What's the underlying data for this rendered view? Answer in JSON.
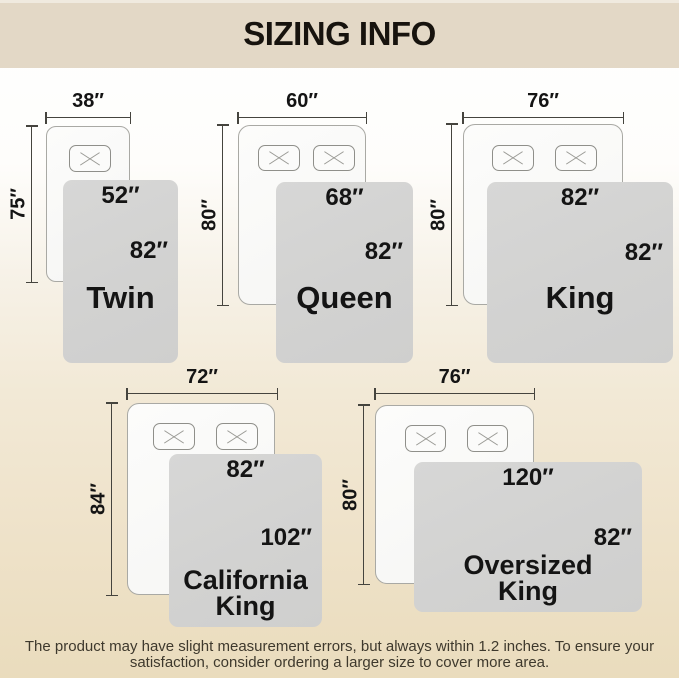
{
  "header": {
    "title": "SIZING INFO"
  },
  "sizes": [
    {
      "name": "Twin",
      "bed_width": "38″",
      "bed_length": "75″",
      "blanket_width": "52″",
      "blanket_length": "82″"
    },
    {
      "name": "Queen",
      "bed_width": "60″",
      "bed_length": "80″",
      "blanket_width": "68″",
      "blanket_length": "82″"
    },
    {
      "name": "King",
      "bed_width": "76″",
      "bed_length": "80″",
      "blanket_width": "82″",
      "blanket_length": "82″"
    },
    {
      "name": "California King",
      "bed_width": "72″",
      "bed_length": "84″",
      "blanket_width": "82″",
      "blanket_length": "102″"
    },
    {
      "name": "Oversized King",
      "bed_width": "76″",
      "bed_length": "80″",
      "blanket_width": "120″",
      "blanket_length": "82″"
    }
  ],
  "footer": {
    "line1": "The product may have slight measurement errors, but always within 1.2 inches. To ensure your",
    "line2": "satisfaction, consider ordering a larger size to cover more area."
  },
  "colors": {
    "header_band": "#e3d8c6",
    "background_bottom": "#eadcbd",
    "blanket_gray": "#d3d3d2",
    "bed_white": "#fbfbfa",
    "text": "#141414"
  }
}
